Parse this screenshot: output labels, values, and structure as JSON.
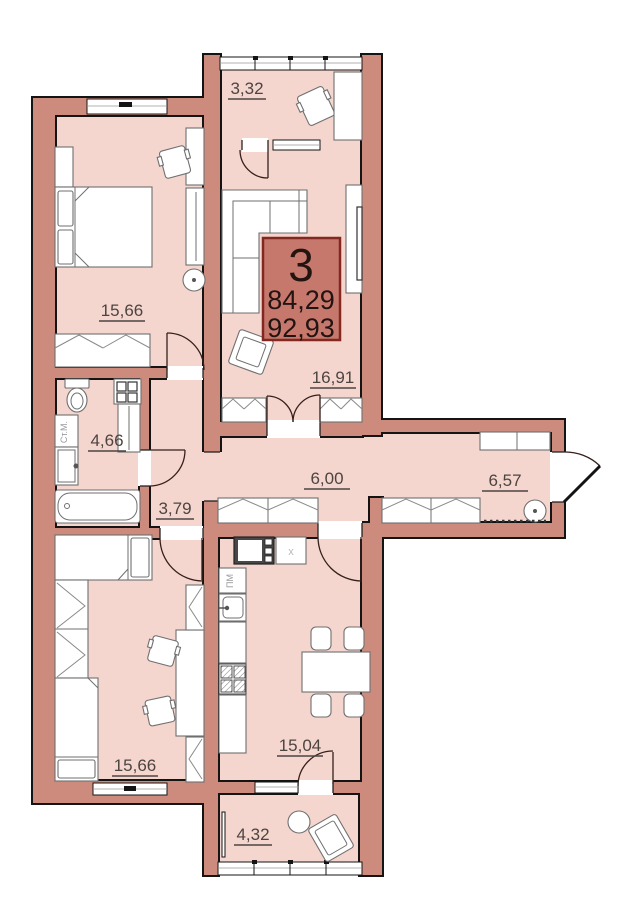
{
  "plan": {
    "unit": {
      "rooms": "3",
      "area1": "84,29",
      "area2": "92,93"
    },
    "rooms": {
      "balcony_top": "3,32",
      "bedroom": "15,66",
      "living": "16,91",
      "bath": "4,66",
      "hall": "3,79",
      "corridor": "6,00",
      "entry": "6,57",
      "kids": "15,66",
      "kitchen": "15,04",
      "balcony_bottom": "4,32"
    },
    "appliances": {
      "washer": "Ст.М.",
      "dishwasher": "ПМ",
      "sink_mark": "x"
    },
    "colors": {
      "wall": "#cd8b7d",
      "floor": "#f4d6ce",
      "outline": "#141414",
      "unit_box_fill": "#c6786c",
      "unit_box_border": "#822820",
      "label_text": "#4d4440"
    }
  }
}
